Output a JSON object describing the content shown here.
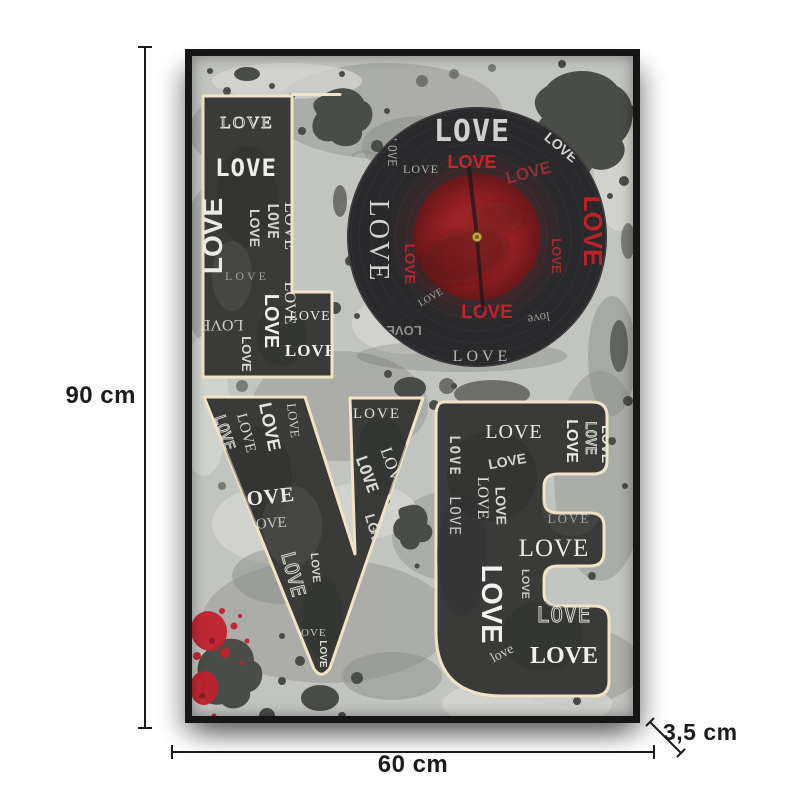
{
  "dimensions": {
    "height": "90 cm",
    "width": "60 cm",
    "depth": "3,5 cm"
  },
  "colors": {
    "dimension_ink": "#1c1c1c",
    "frame": "#161616",
    "canvas_base": "#c2c4c0",
    "grey_mid": "#9fa29c",
    "grey_light": "#d5d7d2",
    "splatter_dark": "#4a4c48",
    "splatter_red": "#c1202c",
    "letter_fill": "#3a3b39",
    "letter_outline": "#f1e3c5",
    "record_black": "#29292b",
    "record_label_red": "#a8262c",
    "clock_pin_gold": "#caa53d",
    "white_text": "#ececea"
  },
  "artwork": {
    "word": "LOVE",
    "letters": [
      {
        "glyph": "L",
        "words": [
          {
            "t": "LOVE",
            "x": 55,
            "y": 72,
            "s": 17,
            "f": "serif",
            "c": "#e4e4e0",
            "ls": 2,
            "outline": true
          },
          {
            "t": "LOVE",
            "x": 54,
            "y": 120,
            "s": 24,
            "f": "mono",
            "w": 700,
            "c": "#ededea",
            "ls": 1
          },
          {
            "t": "LOVE",
            "x": 30,
            "y": 180,
            "s": 28,
            "f": "sans",
            "w": 800,
            "c": "#eaeae7",
            "r": -90
          },
          {
            "t": "LOVE",
            "x": 58,
            "y": 172,
            "s": 14,
            "f": "sans",
            "w": 700,
            "c": "#d6d6d2",
            "r": 90
          },
          {
            "t": "LOVE",
            "x": 76,
            "y": 165,
            "s": 15,
            "f": "mono",
            "w": 700,
            "c": "#cfcfcb",
            "r": 90
          },
          {
            "t": "LOVE",
            "x": 93,
            "y": 170,
            "s": 18,
            "f": "serif",
            "c": "#e0e0dc",
            "r": 90
          },
          {
            "t": "LOVE",
            "x": 55,
            "y": 224,
            "s": 12,
            "f": "serif",
            "c": "#a2a29e",
            "ls": 3
          },
          {
            "t": "LOVE",
            "x": 93,
            "y": 247,
            "s": 16,
            "f": "serif",
            "c": "#e4e4e0",
            "r": 90
          },
          {
            "t": "LOVE",
            "x": 73,
            "y": 265,
            "s": 20,
            "f": "sans",
            "w": 800,
            "c": "#efefec",
            "r": 90
          },
          {
            "t": "LOVE",
            "x": 30,
            "y": 264,
            "s": 16,
            "f": "serif",
            "c": "#cfcfcb",
            "r": 180
          },
          {
            "t": "LOVE",
            "x": 50,
            "y": 298,
            "s": 13,
            "f": "sans",
            "w": 700,
            "c": "#d8d8d4",
            "r": 90
          },
          {
            "t": "LOVE",
            "x": 118,
            "y": 264,
            "s": 14,
            "f": "serif",
            "c": "#e6e6e2",
            "ls": 1
          },
          {
            "t": "LOVE",
            "x": 119,
            "y": 300,
            "s": 17,
            "f": "serif",
            "w": 700,
            "c": "#f0f0ed",
            "ls": 1
          }
        ]
      },
      {
        "glyph": "O",
        "words": [
          {
            "t": "LOVE",
            "x": 280,
            "y": 85,
            "s": 30,
            "f": "mono",
            "w": 700,
            "c": "#e8e8e5",
            "o": 0.88,
            "ls": 1
          },
          {
            "t": "LOVE",
            "x": 366,
            "y": 95,
            "s": 14,
            "f": "sans",
            "w": 700,
            "c": "#d4d4d1",
            "r": 40
          },
          {
            "t": "LOVE",
            "x": 229,
            "y": 117,
            "s": 12,
            "f": "serif",
            "c": "#b4b4b0",
            "ls": 1
          },
          {
            "t": "LOVE",
            "x": 280,
            "y": 112,
            "s": 18,
            "f": "sans",
            "w": 800,
            "c": "#c4262c"
          },
          {
            "t": "LOVE",
            "x": 338,
            "y": 122,
            "s": 17,
            "f": "sans",
            "w": 800,
            "c": "#a83237",
            "r": -15,
            "o": 0.8
          },
          {
            "t": "LOVE",
            "x": 178,
            "y": 185,
            "s": 28,
            "f": "serif",
            "c": "#d2d3cf",
            "r": 90,
            "ls": 2
          },
          {
            "t": "LOVE",
            "x": 196,
            "y": 96,
            "s": 12,
            "f": "mono",
            "c": "#989894",
            "r": 90
          },
          {
            "t": "LOVE",
            "x": 213,
            "y": 208,
            "s": 15,
            "f": "sans",
            "w": 700,
            "c": "#b02730",
            "r": 90
          },
          {
            "t": "LOVE",
            "x": 392,
            "y": 175,
            "s": 26,
            "f": "sans",
            "w": 800,
            "c": "#bf2028",
            "r": 90
          },
          {
            "t": "LOVE",
            "x": 360,
            "y": 200,
            "s": 13,
            "f": "sans",
            "w": 700,
            "c": "#a42a30",
            "r": 90
          },
          {
            "t": "LOVE",
            "x": 295,
            "y": 262,
            "s": 19,
            "f": "sans",
            "w": 800,
            "c": "#c0232e"
          },
          {
            "t": "LOVE",
            "x": 212,
            "y": 270,
            "s": 13,
            "f": "sans",
            "w": 700,
            "c": "#8f8f8b",
            "r": 180
          },
          {
            "t": "love",
            "x": 346,
            "y": 258,
            "s": 13,
            "f": "serif",
            "c": "#9a9a96",
            "r": 170
          },
          {
            "t": "LOVE",
            "x": 240,
            "y": 244,
            "s": 10,
            "f": "serif",
            "c": "#a8a8a4",
            "r": -30
          },
          {
            "t": "LOVE",
            "x": 290,
            "y": 305,
            "s": 16,
            "f": "serif",
            "c": "#b6b7b3",
            "ls": 4
          }
        ]
      },
      {
        "glyph": "V",
        "words": [
          {
            "t": "LOVE",
            "x": 28,
            "y": 378,
            "s": 15,
            "f": "mono",
            "c": "#dededa",
            "r": 72,
            "outline": true
          },
          {
            "t": "LOVE",
            "x": 50,
            "y": 378,
            "s": 15,
            "f": "serif",
            "c": "#d8d8d4",
            "r": 75
          },
          {
            "t": "LOVE",
            "x": 72,
            "y": 372,
            "s": 18,
            "f": "sans",
            "w": 700,
            "c": "#e6e6e2",
            "r": 78
          },
          {
            "t": "LOVE",
            "x": 97,
            "y": 365,
            "s": 13,
            "f": "serif",
            "c": "#cccac8",
            "r": 83
          },
          {
            "t": "LOVE",
            "x": 72,
            "y": 448,
            "s": 21,
            "f": "serif",
            "w": 700,
            "c": "#ebebe8",
            "r": -6,
            "ls": 1
          },
          {
            "t": "LOVE",
            "x": 75,
            "y": 472,
            "s": 15,
            "f": "serif",
            "c": "#c6c6c2",
            "r": -4
          },
          {
            "t": "LOVE",
            "x": 95,
            "y": 520,
            "s": 19,
            "f": "mono",
            "c": "#e2e2de",
            "r": 75,
            "outline": true
          },
          {
            "t": "LOVE",
            "x": 120,
            "y": 512,
            "s": 11,
            "f": "sans",
            "w": 700,
            "c": "#d4d4d0",
            "r": 85
          },
          {
            "t": "LOVE",
            "x": 118,
            "y": 580,
            "s": 11,
            "f": "serif",
            "c": "#c8c8c4",
            "ls": 1
          },
          {
            "t": "LOVE",
            "x": 128,
            "y": 598,
            "s": 10,
            "f": "sans",
            "w": 700,
            "c": "#dcdcd8",
            "r": 90
          },
          {
            "t": "LOVE",
            "x": 185,
            "y": 362,
            "s": 15,
            "f": "serif",
            "c": "#e2e2de",
            "ls": 2
          },
          {
            "t": "LOVE",
            "x": 170,
            "y": 420,
            "s": 16,
            "f": "mono",
            "w": 700,
            "c": "#d8d8d4",
            "r": 70
          },
          {
            "t": "LOVE",
            "x": 196,
            "y": 415,
            "s": 17,
            "f": "serif",
            "c": "#e6e6e2",
            "r": 70
          },
          {
            "t": "LOVE",
            "x": 178,
            "y": 478,
            "s": 14,
            "f": "sans",
            "w": 700,
            "c": "#d0d0cc",
            "r": 74
          },
          {
            "t": "LOVE",
            "x": 200,
            "y": 470,
            "s": 16,
            "f": "serif",
            "c": "#dadad6",
            "r": 188
          }
        ]
      },
      {
        "glyph": "E",
        "words": [
          {
            "t": "LOVE",
            "x": 322,
            "y": 382,
            "s": 20,
            "f": "serif",
            "c": "#e8e8e4",
            "ls": 1
          },
          {
            "t": "LOVE",
            "x": 375,
            "y": 385,
            "s": 16,
            "f": "sans",
            "w": 800,
            "c": "#eaeae6",
            "r": 90
          },
          {
            "t": "LOVE",
            "x": 394,
            "y": 382,
            "s": 14,
            "f": "mono",
            "c": "#dcdcd8",
            "r": 90,
            "outline": true
          },
          {
            "t": "LOVE",
            "x": 410,
            "y": 388,
            "s": 14,
            "f": "sans",
            "w": 700,
            "c": "#e0e0dc",
            "r": 90
          },
          {
            "t": "LOVE",
            "x": 316,
            "y": 410,
            "s": 14,
            "f": "sans",
            "w": 800,
            "c": "#d4d4d0",
            "r": -10
          },
          {
            "t": "LOVE",
            "x": 258,
            "y": 400,
            "s": 14,
            "f": "mono",
            "w": 700,
            "c": "#d0d0cc",
            "r": 90,
            "ls": 2
          },
          {
            "t": "LOVE",
            "x": 258,
            "y": 460,
            "s": 15,
            "f": "mono",
            "c": "#c8c8c4",
            "r": 90,
            "ls": 1
          },
          {
            "t": "LOVE",
            "x": 286,
            "y": 442,
            "s": 16,
            "f": "serif",
            "c": "#e0e0dc",
            "r": 90
          },
          {
            "t": "LOVE",
            "x": 304,
            "y": 450,
            "s": 14,
            "f": "sans",
            "w": 700,
            "c": "#d8d8d4",
            "r": 88
          },
          {
            "t": "LOVE",
            "x": 377,
            "y": 467,
            "s": 13,
            "f": "serif",
            "c": "#a6a6a2",
            "ls": 2
          },
          {
            "t": "LOVE",
            "x": 362,
            "y": 500,
            "s": 25,
            "f": "serif",
            "c": "#ececea",
            "ls": 1
          },
          {
            "t": "LOVE",
            "x": 290,
            "y": 548,
            "s": 29,
            "f": "sans",
            "w": 800,
            "c": "#f0f0ee",
            "r": 90
          },
          {
            "t": "LOVE",
            "x": 330,
            "y": 528,
            "s": 11,
            "f": "sans",
            "w": 700,
            "c": "#c4c4c0",
            "r": 90
          },
          {
            "t": "LOVE",
            "x": 372,
            "y": 566,
            "s": 21,
            "f": "mono",
            "c": "#e6e6e2",
            "ls": 1,
            "outline": true
          },
          {
            "t": "love",
            "x": 312,
            "y": 601,
            "s": 14,
            "f": "serif",
            "c": "#ccccc8",
            "r": -28
          },
          {
            "t": "LOVE",
            "x": 372,
            "y": 607,
            "s": 24,
            "f": "serif",
            "w": 700,
            "c": "#efefec"
          }
        ]
      }
    ]
  }
}
